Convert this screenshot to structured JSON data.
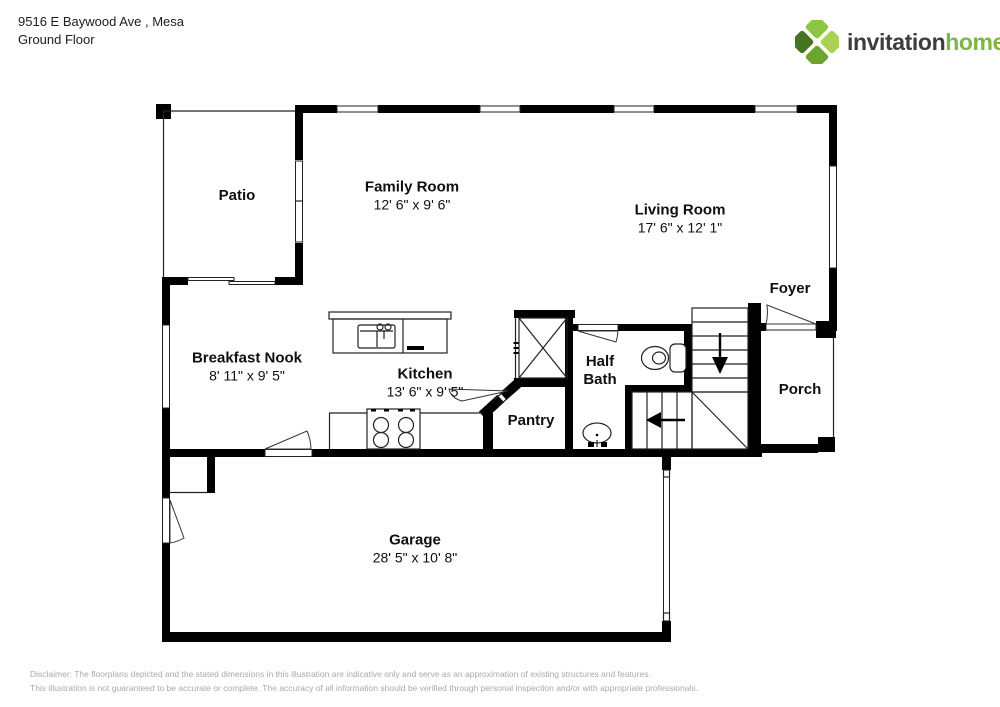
{
  "header": {
    "address_line1": "9516 E Baywood Ave , Mesa",
    "address_line2": "Ground Floor",
    "logo": {
      "word1": "invitation",
      "word2": "homes",
      "trademark": "™"
    }
  },
  "floorplan": {
    "rooms": [
      {
        "id": "patio",
        "name": "Patio",
        "dims": ""
      },
      {
        "id": "family-room",
        "name": "Family Room",
        "dims": "12' 6\" x 9' 6\""
      },
      {
        "id": "living-room",
        "name": "Living Room",
        "dims": "17' 6\" x 12' 1\""
      },
      {
        "id": "foyer",
        "name": "Foyer",
        "dims": ""
      },
      {
        "id": "breakfast-nook",
        "name": "Breakfast Nook",
        "dims": "8' 11\" x 9' 5\""
      },
      {
        "id": "kitchen",
        "name": "Kitchen",
        "dims": "13' 6\" x 9' 5\""
      },
      {
        "id": "half-bath",
        "name": "Half Bath",
        "dims": ""
      },
      {
        "id": "pantry",
        "name": "Pantry",
        "dims": ""
      },
      {
        "id": "porch",
        "name": "Porch",
        "dims": ""
      },
      {
        "id": "garage",
        "name": "Garage",
        "dims": "28' 5\" x 10' 8\""
      }
    ]
  },
  "footer": {
    "disclaimer_line1": "Disclaimer: The floorplans depicted and the stated dimensions in this illustration are indicative only and serve as an approximation of existing structures and features.",
    "disclaimer_line2": "This illustration is not guaranteed to be accurate or complete. The accuracy of all information should be verified through personal inspection and/or with appropriate professionals."
  },
  "colors": {
    "wall": "#000000",
    "brand_green": "#7CB647",
    "brand_dark": "#3D3D3D",
    "disclaimer_gray": "#A9A9A9"
  }
}
